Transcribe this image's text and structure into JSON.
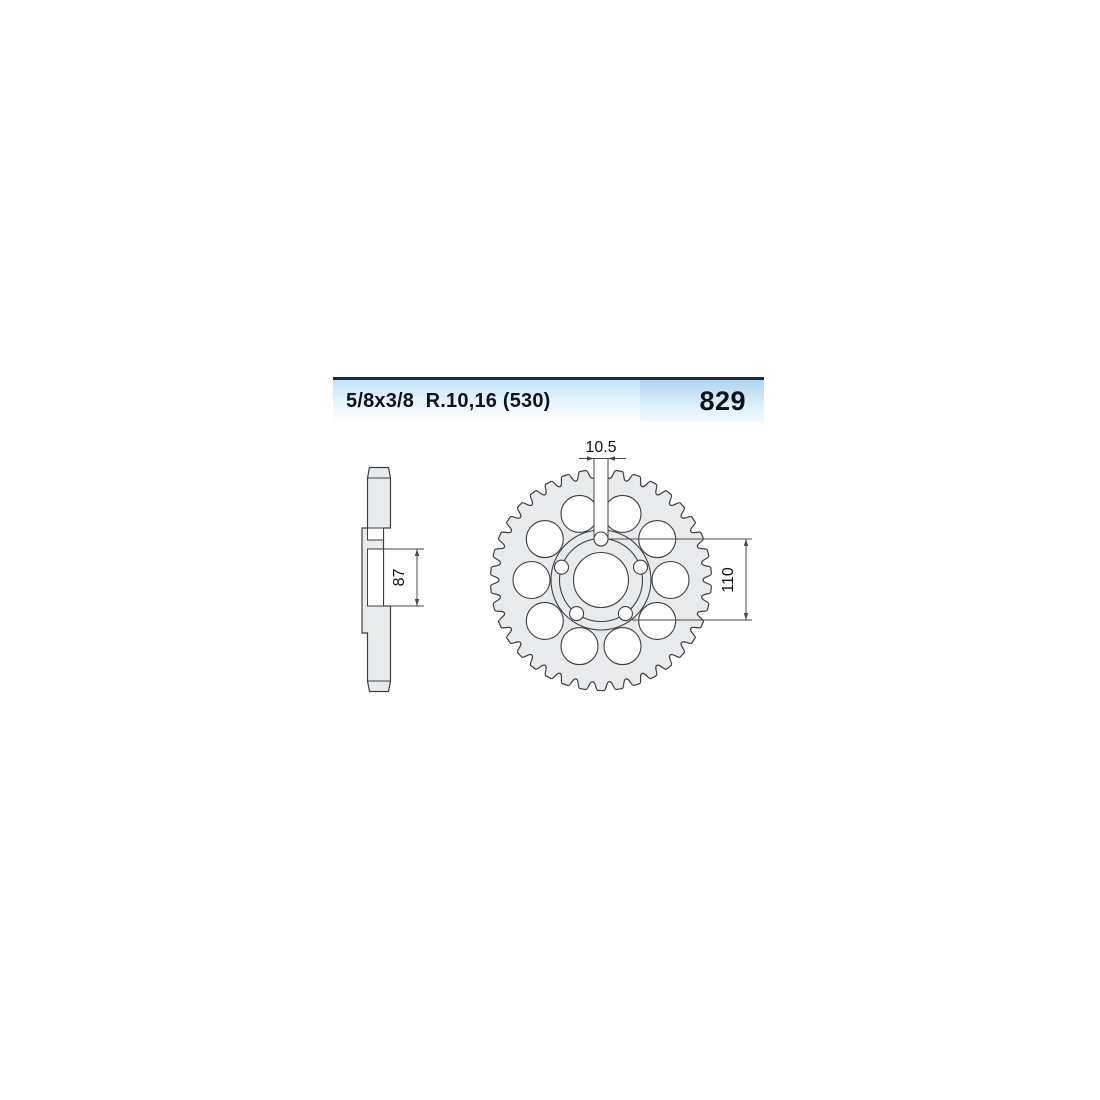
{
  "header": {
    "chain_spec": "5/8x3/8  R.10,16 (530)",
    "part_number": "829"
  },
  "drawing": {
    "side_view": {
      "hub_diameter_label": "87"
    },
    "front_view": {
      "bolt_hole_diameter_label": "10.5",
      "bolt_circle_diameter_label": "110",
      "teeth_count": 38,
      "lightening_hole_count": 10,
      "bolt_hole_count": 5
    },
    "colors": {
      "metal_fill": "#e9eaeb",
      "outline": "#3c4044",
      "dimension_line": "#4a4a4a",
      "header_border": "#1c2a47",
      "header_blue_left": "#c3e3f4",
      "header_blue_right": "#aed7ee"
    }
  }
}
